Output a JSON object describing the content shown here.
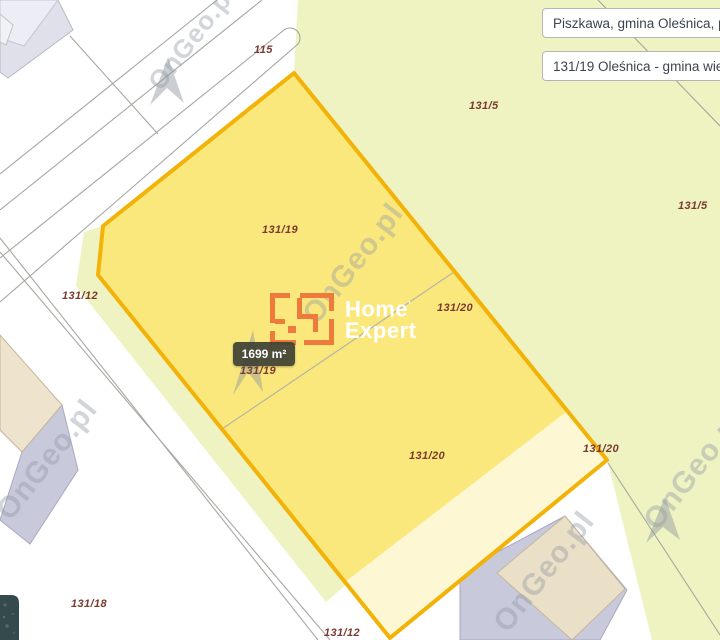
{
  "map": {
    "watermark_text": "OnGeo.pl",
    "area_badge": "1699 m²",
    "labels": [
      {
        "kind": "road-number",
        "text": "115"
      },
      {
        "kind": "parcel-number",
        "text": "131/5"
      },
      {
        "kind": "parcel-number",
        "text": "131/5"
      },
      {
        "kind": "parcel-number",
        "text": "131/19"
      },
      {
        "kind": "parcel-number",
        "text": "131/12"
      },
      {
        "kind": "parcel-number",
        "text": "131/20"
      },
      {
        "kind": "parcel-number",
        "text": "131/19"
      },
      {
        "kind": "parcel-number",
        "text": "131/20"
      },
      {
        "kind": "parcel-number",
        "text": "131/20"
      },
      {
        "kind": "parcel-number",
        "text": "131/18"
      },
      {
        "kind": "parcel-number",
        "text": "131/12"
      }
    ],
    "colors": {
      "highlight_parcel_fill": "#fbe87d",
      "highlight_parcel_border": "#f2b208",
      "subparcel_fill": "#fdf7d4",
      "adjacent_parcel_fill": "#eef3c1",
      "label_color": "#7a3a30",
      "badge_bg": "#40453a"
    }
  },
  "info_boxes": {
    "location": "Piszkawa, gmina Oleśnica, p",
    "parcel": "131/19 Oleśnica - gmina wiej"
  },
  "logo": {
    "word1": "Home",
    "mark": "’",
    "word2": "Expert"
  }
}
